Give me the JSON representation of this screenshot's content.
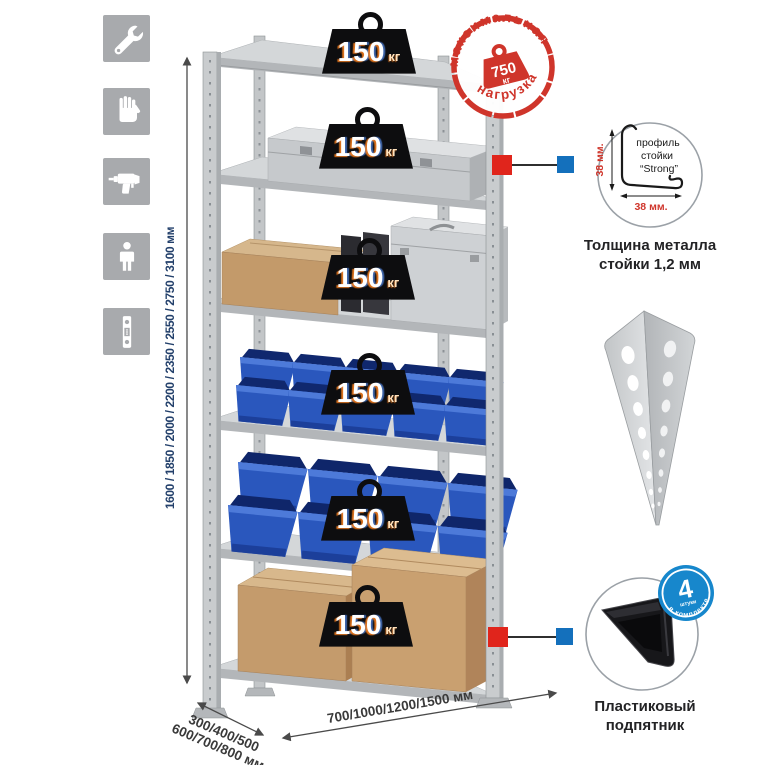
{
  "colors": {
    "stamp_red": "#cf352b",
    "connector_red": "#e0251c",
    "connector_blue": "#1470bc",
    "badge_blue": "#1787cc",
    "bin_blue": "#2a57bd",
    "dimension_text": "#23406b",
    "icon_tile_gray": "#a8aaad"
  },
  "sidebar": {
    "icons": [
      {
        "name": "wrench"
      },
      {
        "name": "gloves"
      },
      {
        "name": "drill"
      },
      {
        "name": "person"
      },
      {
        "name": "upright-profile"
      }
    ]
  },
  "dimensions": {
    "height": "1600 / 1850 / 2000 / 2200 / 2350 / 2550 / 2750 / 3100 мм",
    "depth_line1": "300/400/500",
    "depth_line2": "600/700/800 мм",
    "width": "700/1000/1200/1500 мм"
  },
  "weights": {
    "items": [
      {
        "value": "150",
        "unit": "кг"
      },
      {
        "value": "150",
        "unit": "кг"
      },
      {
        "value": "150",
        "unit": "кг"
      },
      {
        "value": "150",
        "unit": "кг"
      },
      {
        "value": "150",
        "unit": "кг"
      },
      {
        "value": "150",
        "unit": "кг"
      }
    ]
  },
  "stamp": {
    "arc_top": "максимальная",
    "arc_bottom": "нагрузка",
    "value": "750",
    "unit": "кг"
  },
  "profile_detail": {
    "label_line1": "профиль",
    "label_line2": "стойки",
    "label_line3": "“Strong”",
    "dim_vertical": "38 мм.",
    "dim_horizontal": "38 мм.",
    "caption_line1": "Толщина металла",
    "caption_line2": "стойки 1,2 мм"
  },
  "foot_detail": {
    "badge_value": "4",
    "badge_sub": "штуки",
    "badge_arc": "в комплекте",
    "caption_line1": "Пластиковый",
    "caption_line2": "подпятник"
  }
}
